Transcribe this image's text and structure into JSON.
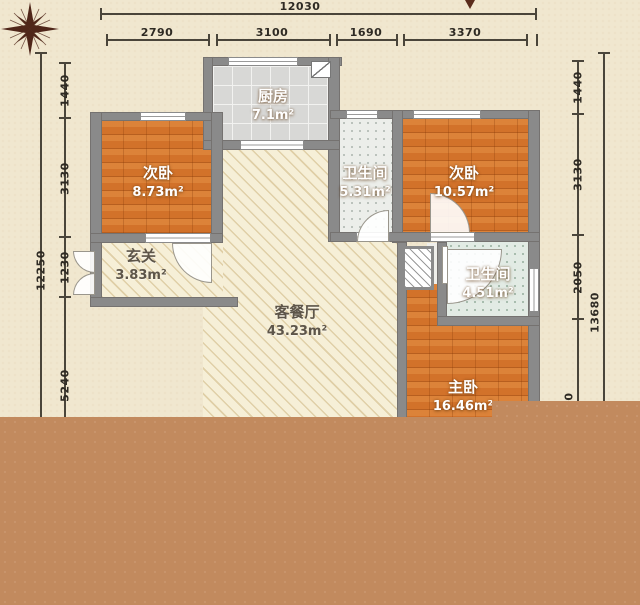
{
  "plan_title": "apartment floor plan",
  "colors": {
    "background": "#f0e7cf",
    "wall": "#8a8a8a",
    "bedroom_floor": "#d2722a",
    "kitchen_tile": "#d8d8d6",
    "bath_tile": "#eceeea",
    "bath_tile_2": "#e2ebe4",
    "living_hatch": "#f6efd7",
    "cutoff_brown": "#c28a5e",
    "dimension_text": "#2e2a23",
    "compass": "#4f2619"
  },
  "icons": {
    "compass": "compass-rose",
    "cursor": "cursor-arrow",
    "kitchen_door": "door-leaf"
  },
  "dimensions": {
    "top": {
      "total": "12030",
      "segments": [
        "2790",
        "3100",
        "1690",
        "3370"
      ]
    },
    "left": {
      "total": "12250",
      "segments": [
        "1440",
        "3130",
        "1230",
        "5240"
      ]
    },
    "right": {
      "total": "13680",
      "segments": [
        "1440",
        "3130",
        "2050"
      ],
      "partial": "0"
    }
  },
  "rooms": [
    {
      "name": "厨房",
      "area": "7.1m²"
    },
    {
      "name": "次卧",
      "area": "8.73m²"
    },
    {
      "name": "卫生间",
      "area": "5.31m²"
    },
    {
      "name": "次卧",
      "area": "10.57m²"
    },
    {
      "name": "玄关",
      "area": "3.83m²"
    },
    {
      "name": "客餐厅",
      "area": "43.23m²"
    },
    {
      "name": "卫生间",
      "area": "4.51m²"
    },
    {
      "name": "主卧",
      "area": "16.46m²"
    }
  ]
}
